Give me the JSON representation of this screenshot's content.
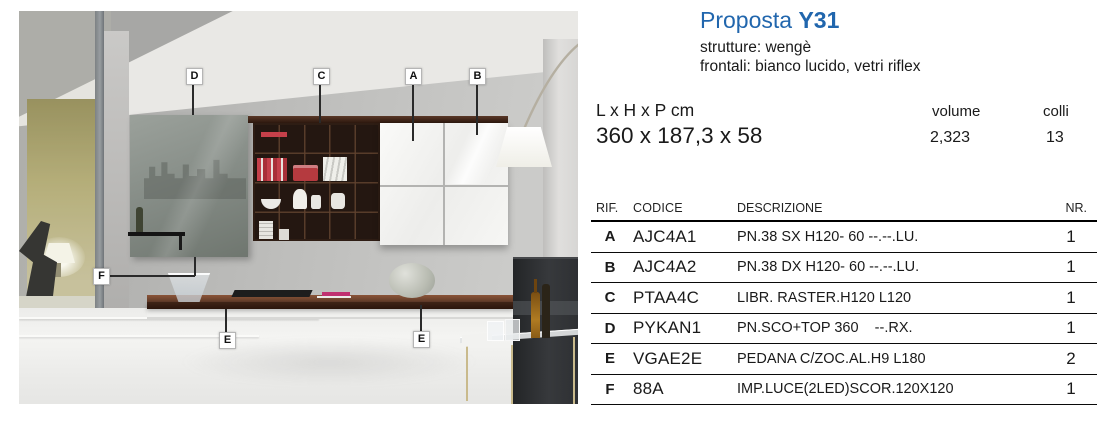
{
  "header": {
    "title_prefix": "Proposta",
    "title_code": "Y31",
    "finish_line1": "strutture: wengè",
    "finish_line2": "frontali: bianco lucido, vetri riflex"
  },
  "specs": {
    "dimensions_label": "L x H x P cm",
    "dimensions_value": "360 x 187,3 x 58",
    "volume_label": "volume",
    "volume_value": "2,323",
    "colli_label": "colli",
    "colli_value": "13"
  },
  "parts_table": {
    "columns": [
      "RIF.",
      "CODICE",
      "DESCRIZIONE",
      "NR."
    ],
    "rows": [
      {
        "rif": "A",
        "codice": "AJC4A1",
        "descrizione": "PN.38 SX H120- 60 --.--.LU.",
        "nr": "1"
      },
      {
        "rif": "B",
        "codice": "AJC4A2",
        "descrizione": "PN.38 DX H120- 60 --.--.LU.",
        "nr": "1"
      },
      {
        "rif": "C",
        "codice": "PTAA4C",
        "descrizione": "LIBR. RASTER.H120 L120",
        "nr": "1"
      },
      {
        "rif": "D",
        "codice": "PYKAN1",
        "descrizione": "PN.SCO+TOP 360    --.RX.",
        "nr": "1"
      },
      {
        "rif": "E",
        "codice": "VGAE2E",
        "descrizione": "PEDANA C/ZOC.AL.H9 L180",
        "nr": "2"
      },
      {
        "rif": "F",
        "codice": "88A",
        "descrizione": "IMP.LUCE(2LED)SCOR.120X120",
        "nr": "1"
      }
    ]
  },
  "photo": {
    "labels": [
      {
        "letter": "D"
      },
      {
        "letter": "C"
      },
      {
        "letter": "A"
      },
      {
        "letter": "B"
      },
      {
        "letter": "F"
      },
      {
        "letter": "E"
      },
      {
        "letter": "E"
      }
    ]
  },
  "colors": {
    "accent_blue": "#2166ad",
    "wenge_brown": "#3a241c",
    "glossy_white": "#f4f4f2"
  }
}
